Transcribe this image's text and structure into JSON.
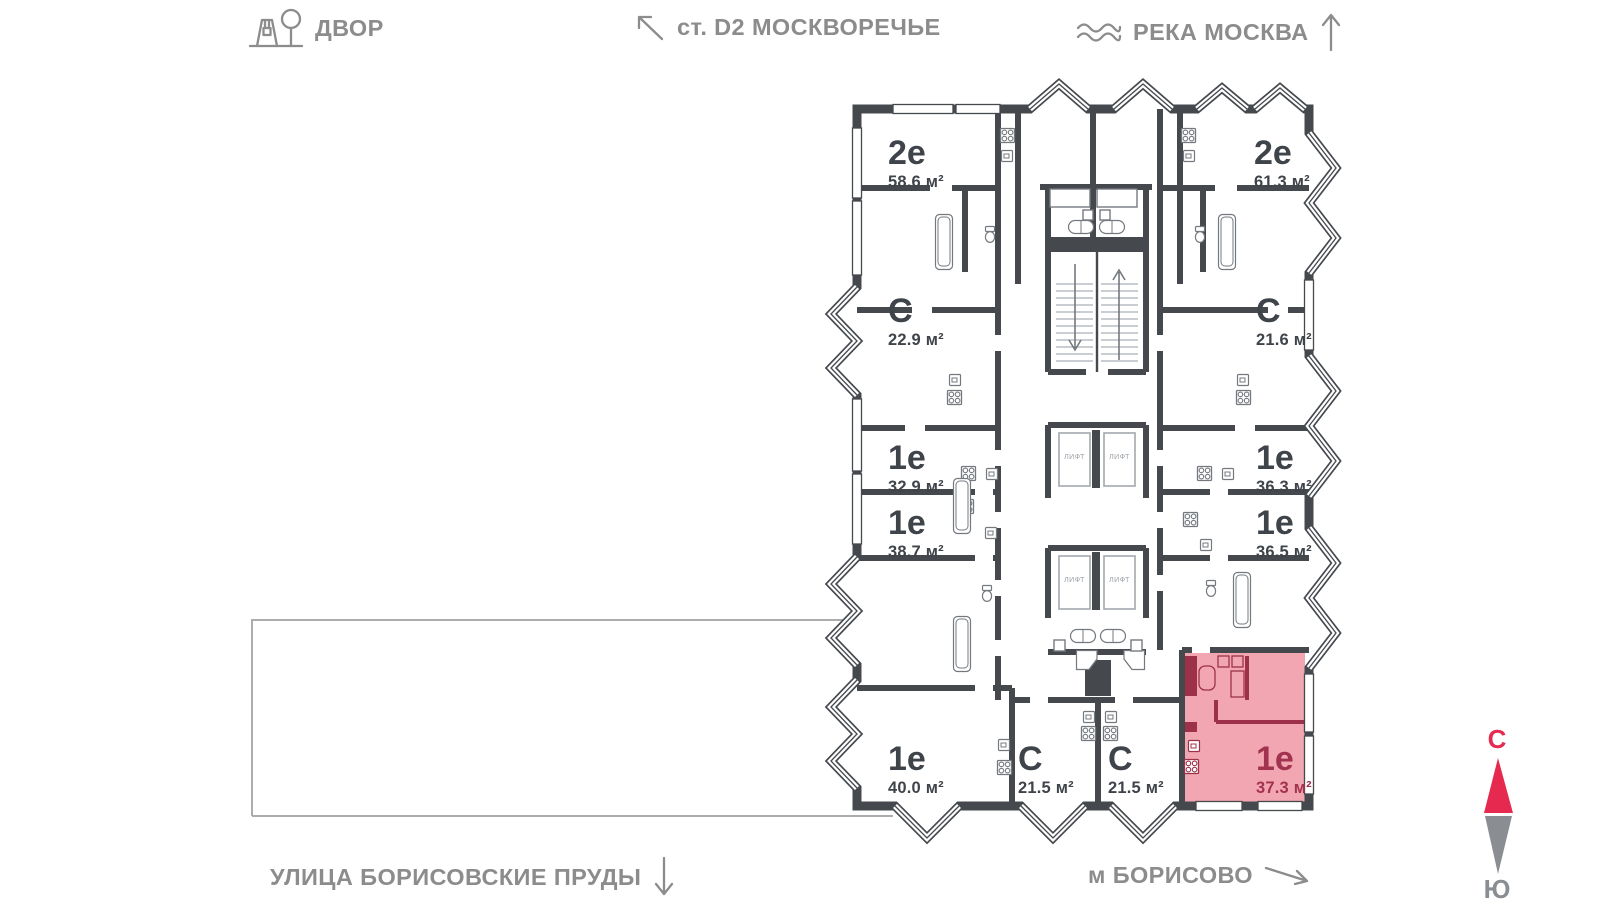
{
  "map_labels": {
    "courtyard": "ДВОР",
    "station": "ст. D2 МОСКВОРЕЧЬЕ",
    "river": "РЕКА МОСКВА",
    "street": "УЛИЦА БОРИСОВСКИЕ ПРУДЫ",
    "metro": "м БОРИСОВО"
  },
  "compass": {
    "north": "С",
    "south": "Ю"
  },
  "core": {
    "elevator_label": "ЛИФТ"
  },
  "apartments": [
    {
      "type": "2е",
      "area": "58.6 м²",
      "highlighted": false
    },
    {
      "type": "С",
      "area": "22.9 м²",
      "highlighted": false
    },
    {
      "type": "1е",
      "area": "32.9 м²",
      "highlighted": false
    },
    {
      "type": "1е",
      "area": "38.7 м²",
      "highlighted": false
    },
    {
      "type": "1е",
      "area": "40.0 м²",
      "highlighted": false
    },
    {
      "type": "С",
      "area": "21.5 м²",
      "highlighted": false
    },
    {
      "type": "С",
      "area": "21.5 м²",
      "highlighted": false
    },
    {
      "type": "1е",
      "area": "37.3 м²",
      "highlighted": true
    },
    {
      "type": "1е",
      "area": "36.5 м²",
      "highlighted": false
    },
    {
      "type": "1е",
      "area": "36.3 м²",
      "highlighted": false
    },
    {
      "type": "С",
      "area": "21.6 м²",
      "highlighted": false
    },
    {
      "type": "2е",
      "area": "61.3 м²",
      "highlighted": false
    }
  ],
  "colors": {
    "wall": "#45494e",
    "label_text": "#3f444a",
    "nav_text": "#8c8c8c",
    "highlight_fill": "#f2a6b1",
    "highlight_accent": "#a23350",
    "compass_north": "#e62a4f",
    "compass_south": "#8a8e92",
    "plot_border": "#acacac"
  }
}
